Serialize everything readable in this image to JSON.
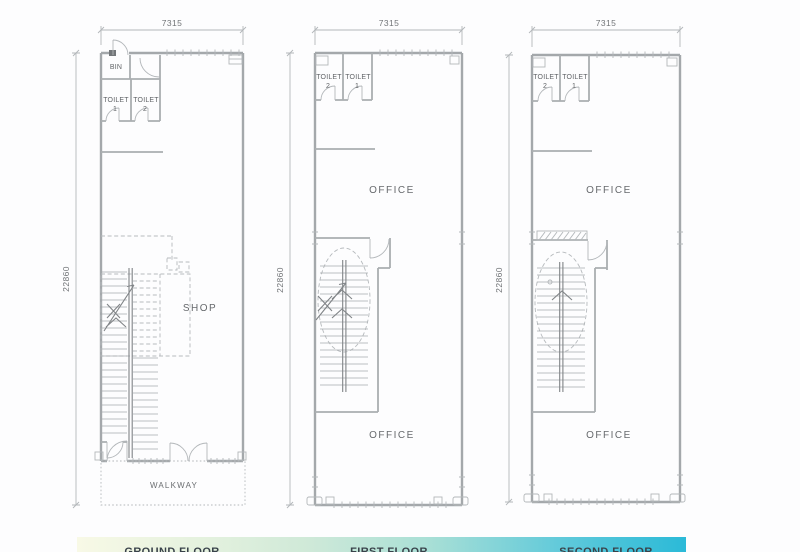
{
  "floors": [
    {
      "name_label": "GROUND FLOOR",
      "width_dim": "7315",
      "height_dim": "22860",
      "rooms": {
        "bin": "BIN",
        "toilet_left": "TOILET",
        "toilet_left_num": "1",
        "toilet_right": "TOILET",
        "toilet_right_num": "2",
        "main": "SHOP",
        "walkway": "WALKWAY"
      }
    },
    {
      "name_label": "FIRST FLOOR",
      "width_dim": "7315",
      "height_dim": "22860",
      "rooms": {
        "toilet_left": "TOILET",
        "toilet_left_num": "2",
        "toilet_right": "TOILET",
        "toilet_right_num": "1",
        "office_top": "OFFICE",
        "office_bottom": "OFFICE"
      }
    },
    {
      "name_label": "SECOND FLOOR",
      "width_dim": "7315",
      "height_dim": "22860",
      "rooms": {
        "toilet_left": "TOILET",
        "toilet_left_num": "2",
        "toilet_right": "TOILET",
        "toilet_right_num": "1",
        "office_top": "OFFICE",
        "office_bottom": "OFFICE"
      }
    }
  ],
  "banner": {
    "gradient_left": "#f8f9e6",
    "gradient_mid": "#cfe9d8",
    "gradient_right": "#2bbad8"
  }
}
